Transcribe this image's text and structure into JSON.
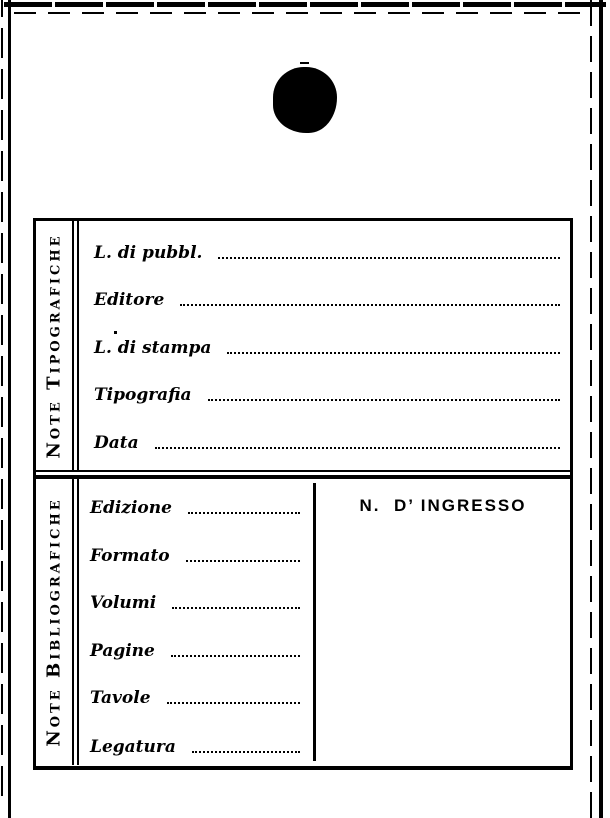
{
  "colors": {
    "ink": "#000000",
    "paper": "#ffffff"
  },
  "card": {
    "sections": [
      {
        "title": "Note Tipografiche",
        "fields": [
          {
            "label": "L. di pubbl.",
            "value": ""
          },
          {
            "label": "Editore",
            "value": ""
          },
          {
            "label": "L. di stampa",
            "value": ""
          },
          {
            "label": "Tipografia",
            "value": ""
          },
          {
            "label": "Data",
            "value": ""
          }
        ]
      },
      {
        "title": "Note Bibliografiche",
        "fields": [
          {
            "label": "Edizione",
            "value": ""
          },
          {
            "label": "Formato",
            "value": ""
          },
          {
            "label": "Volumi",
            "value": ""
          },
          {
            "label": "Pagine",
            "value": ""
          },
          {
            "label": "Tavole",
            "value": ""
          },
          {
            "label": "Legatura",
            "value": ""
          }
        ],
        "accession_label": "N.  D’ INGRESSO"
      }
    ]
  }
}
